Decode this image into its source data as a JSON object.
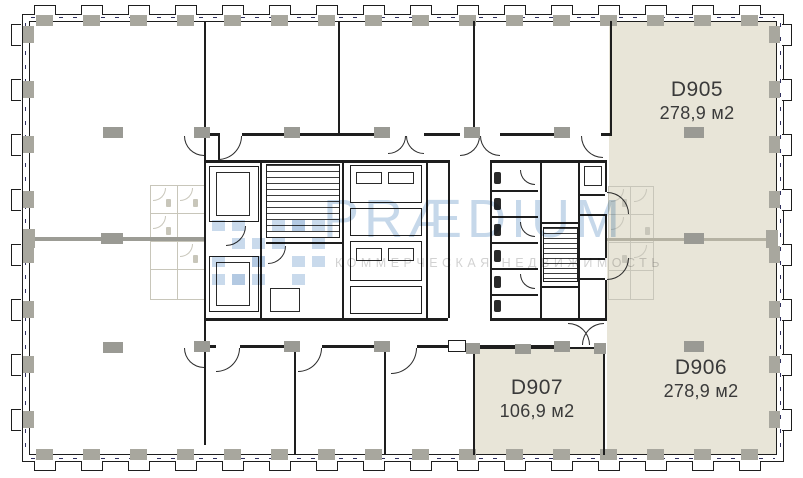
{
  "plan": {
    "units": [
      {
        "id": "D905",
        "area": "278,9 м2"
      },
      {
        "id": "D906",
        "area": "278,9 м2"
      },
      {
        "id": "D907",
        "area": "106,9 м2"
      }
    ],
    "highlight_color": "#e8e5d8"
  },
  "watermark": {
    "brand": "PRÆDIUM",
    "subtitle": "КОММЕРЧЕСКАЯ НЕДВИЖИМОСТЬ",
    "brand_color": "#c6d8ea",
    "subtitle_color": "#d2d2d2"
  }
}
